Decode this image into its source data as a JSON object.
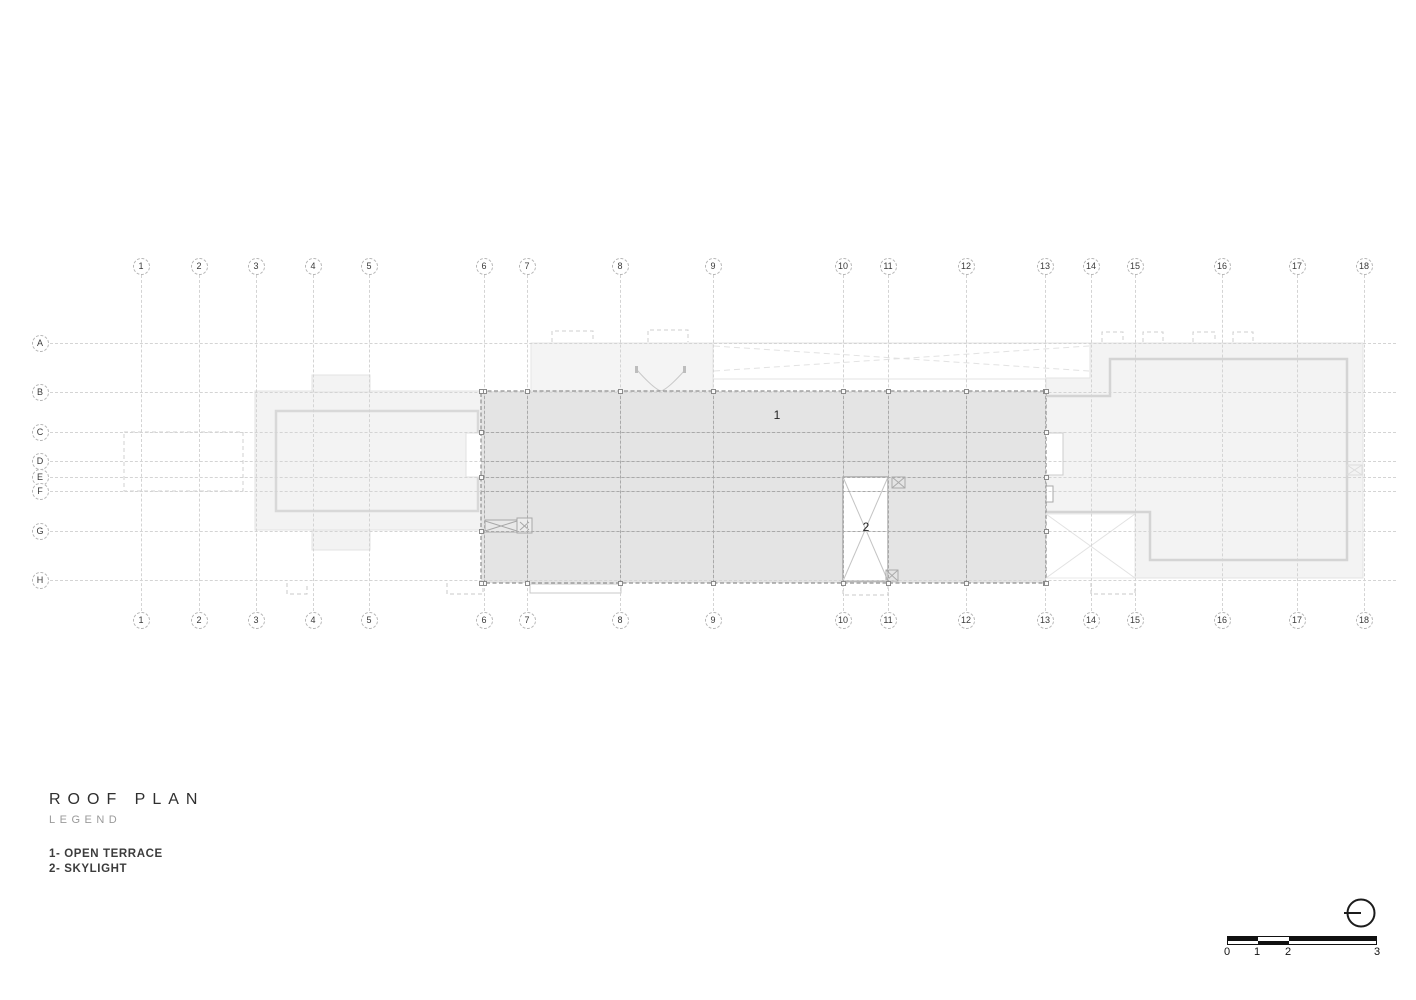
{
  "legend": {
    "title": "ROOF PLAN",
    "subtitle": "LEGEND",
    "items": [
      "1- OPEN TERRACE",
      "2- SKYLIGHT"
    ]
  },
  "grid": {
    "columns": [
      {
        "label": "1",
        "x": 141
      },
      {
        "label": "2",
        "x": 199
      },
      {
        "label": "3",
        "x": 256
      },
      {
        "label": "4",
        "x": 313
      },
      {
        "label": "5",
        "x": 369
      },
      {
        "label": "6",
        "x": 484
      },
      {
        "label": "7",
        "x": 527
      },
      {
        "label": "8",
        "x": 620
      },
      {
        "label": "9",
        "x": 713
      },
      {
        "label": "10",
        "x": 843
      },
      {
        "label": "11",
        "x": 888
      },
      {
        "label": "12",
        "x": 966
      },
      {
        "label": "13",
        "x": 1045
      },
      {
        "label": "14",
        "x": 1091
      },
      {
        "label": "15",
        "x": 1135
      },
      {
        "label": "16",
        "x": 1222
      },
      {
        "label": "17",
        "x": 1297
      },
      {
        "label": "18",
        "x": 1364
      }
    ],
    "rows": [
      {
        "label": "A",
        "y": 343
      },
      {
        "label": "B",
        "y": 392
      },
      {
        "label": "C",
        "y": 432
      },
      {
        "label": "D",
        "y": 461
      },
      {
        "label": "E",
        "y": 477
      },
      {
        "label": "F",
        "y": 491
      },
      {
        "label": "G",
        "y": 531
      },
      {
        "label": "H",
        "y": 580
      }
    ],
    "bubble_top_cy": 266,
    "bubble_bottom_cy": 620,
    "bubble_left_cx": 40,
    "line_top": 275,
    "line_bottom": 611,
    "line_left": 50,
    "line_right": 1396
  },
  "plan": {
    "annotations": [
      {
        "label": "1",
        "x": 777,
        "y": 415
      },
      {
        "label": "2",
        "x": 866,
        "y": 527
      }
    ],
    "terrace": {
      "x": 481,
      "y": 391,
      "w": 565,
      "h": 192
    },
    "marker_columns_x": [
      484,
      527,
      620,
      713,
      843,
      888,
      966,
      1045
    ],
    "marker_rows_y": [
      391,
      432,
      477,
      531,
      583
    ],
    "terrace_rows_y": [
      432,
      461,
      477,
      491,
      531
    ]
  },
  "scale_bar": {
    "ticks": [
      {
        "label": "0",
        "x": 1227
      },
      {
        "label": "1",
        "x": 1257
      },
      {
        "label": "2",
        "x": 1288
      },
      {
        "label": "3",
        "x": 1377
      }
    ]
  },
  "colors": {
    "terrace_fill": "#e4e4e4",
    "roof_fill": "#f3f3f3",
    "grid_grey": "#d4d4d4",
    "outline_grey": "#d4d4d4",
    "dark": "#111111"
  }
}
